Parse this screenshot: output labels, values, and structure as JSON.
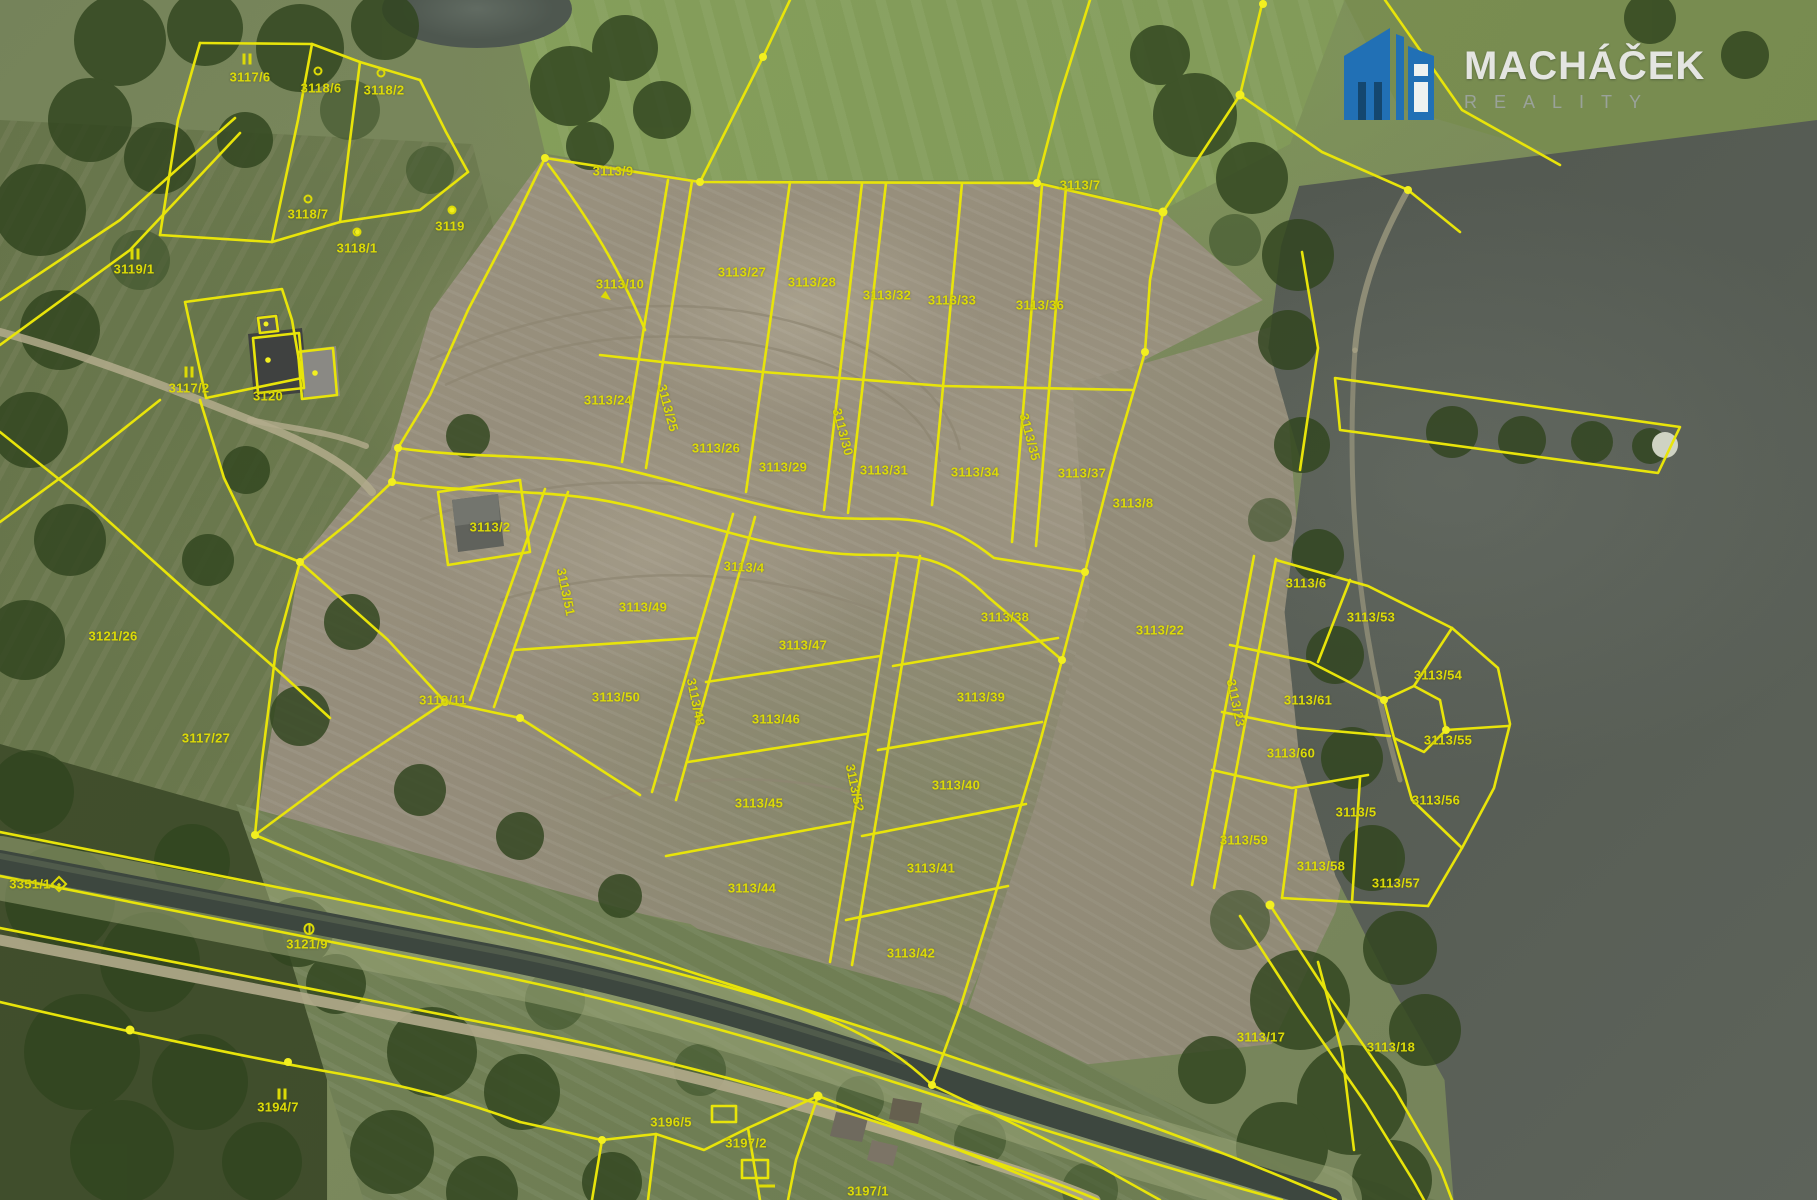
{
  "logo": {
    "title": "MACHÁČEK",
    "subtitle": "REALITY"
  },
  "map": {
    "colors": {
      "parcel_line": "#e8e40a",
      "parcel_label": "#dcda07",
      "logo_blue": "#2170b5",
      "logo_title": "#e4e5e1",
      "logo_subtitle": "#9aa29a",
      "water": "#575d56",
      "cleared_land": "#948c7a"
    },
    "parcel_labels": [
      {
        "t": "3117/6",
        "x": 250,
        "y": 77
      },
      {
        "t": "3118/6",
        "x": 321,
        "y": 88
      },
      {
        "t": "3118/2",
        "x": 384,
        "y": 90
      },
      {
        "t": "3118/7",
        "x": 308,
        "y": 214
      },
      {
        "t": "3119/1",
        "x": 134,
        "y": 269
      },
      {
        "t": "3118/1",
        "x": 357,
        "y": 248
      },
      {
        "t": "3119",
        "x": 450,
        "y": 226
      },
      {
        "t": "3113/9",
        "x": 613,
        "y": 171
      },
      {
        "t": "3113/7",
        "x": 1080,
        "y": 185
      },
      {
        "t": "3117/2",
        "x": 189,
        "y": 388
      },
      {
        "t": "3120",
        "x": 268,
        "y": 396
      },
      {
        "t": "3113/10",
        "x": 620,
        "y": 284
      },
      {
        "t": "3113/27",
        "x": 742,
        "y": 272
      },
      {
        "t": "3113/28",
        "x": 812,
        "y": 282
      },
      {
        "t": "3113/32",
        "x": 887,
        "y": 295
      },
      {
        "t": "3113/33",
        "x": 952,
        "y": 300
      },
      {
        "t": "3113/36",
        "x": 1040,
        "y": 305
      },
      {
        "t": "3113/24",
        "x": 608,
        "y": 400
      },
      {
        "t": "3113/25",
        "x": 668,
        "y": 408,
        "r": 75
      },
      {
        "t": "3113/26",
        "x": 716,
        "y": 448
      },
      {
        "t": "3113/29",
        "x": 783,
        "y": 467
      },
      {
        "t": "3113/30",
        "x": 843,
        "y": 432,
        "r": 75
      },
      {
        "t": "3113/31",
        "x": 884,
        "y": 470
      },
      {
        "t": "3113/34",
        "x": 975,
        "y": 472
      },
      {
        "t": "3113/35",
        "x": 1030,
        "y": 437,
        "r": 75
      },
      {
        "t": "3113/37",
        "x": 1082,
        "y": 473
      },
      {
        "t": "3113/4",
        "x": 744,
        "y": 567,
        "r": 3
      },
      {
        "t": "3113/2",
        "x": 490,
        "y": 527
      },
      {
        "t": "3113/51",
        "x": 566,
        "y": 592,
        "r": 78
      },
      {
        "t": "3113/49",
        "x": 643,
        "y": 607
      },
      {
        "t": "3113/50",
        "x": 616,
        "y": 697
      },
      {
        "t": "3113/48",
        "x": 696,
        "y": 702,
        "r": 78
      },
      {
        "t": "3113/47",
        "x": 803,
        "y": 645
      },
      {
        "t": "3113/46",
        "x": 776,
        "y": 719
      },
      {
        "t": "3113/45",
        "x": 759,
        "y": 803
      },
      {
        "t": "3113/52",
        "x": 855,
        "y": 788,
        "r": 78
      },
      {
        "t": "3113/44",
        "x": 752,
        "y": 888
      },
      {
        "t": "3113/38",
        "x": 1005,
        "y": 617
      },
      {
        "t": "3113/39",
        "x": 981,
        "y": 697
      },
      {
        "t": "3113/40",
        "x": 956,
        "y": 785
      },
      {
        "t": "3113/41",
        "x": 931,
        "y": 868
      },
      {
        "t": "3113/42",
        "x": 911,
        "y": 953
      },
      {
        "t": "3113/8",
        "x": 1133,
        "y": 503
      },
      {
        "t": "3113/22",
        "x": 1160,
        "y": 630
      },
      {
        "t": "3113/23",
        "x": 1236,
        "y": 703,
        "r": 78
      },
      {
        "t": "3113/61",
        "x": 1308,
        "y": 700
      },
      {
        "t": "3113/60",
        "x": 1291,
        "y": 753
      },
      {
        "t": "3113/59",
        "x": 1244,
        "y": 840
      },
      {
        "t": "3113/58",
        "x": 1321,
        "y": 866
      },
      {
        "t": "3113/57",
        "x": 1396,
        "y": 883
      },
      {
        "t": "3113/5",
        "x": 1356,
        "y": 812
      },
      {
        "t": "3113/6",
        "x": 1306,
        "y": 583
      },
      {
        "t": "3113/53",
        "x": 1371,
        "y": 617
      },
      {
        "t": "3113/54",
        "x": 1438,
        "y": 675
      },
      {
        "t": "3113/55",
        "x": 1448,
        "y": 740
      },
      {
        "t": "3113/56",
        "x": 1436,
        "y": 800
      },
      {
        "t": "3113/17",
        "x": 1261,
        "y": 1037
      },
      {
        "t": "3113/18",
        "x": 1391,
        "y": 1047
      },
      {
        "t": "3113/11",
        "x": 443,
        "y": 700
      },
      {
        "t": "3117/27",
        "x": 206,
        "y": 738
      },
      {
        "t": "3121/26",
        "x": 113,
        "y": 636
      },
      {
        "t": "3121/9",
        "x": 307,
        "y": 944
      },
      {
        "t": "3351/1",
        "x": 30,
        "y": 884
      },
      {
        "t": "3194/7",
        "x": 278,
        "y": 1107
      },
      {
        "t": "3196/5",
        "x": 671,
        "y": 1122
      },
      {
        "t": "3197/2",
        "x": 746,
        "y": 1143
      },
      {
        "t": "3197/1",
        "x": 868,
        "y": 1191
      }
    ],
    "survey_markers": [
      {
        "k": "ii",
        "x": 247,
        "y": 59
      },
      {
        "k": "ii",
        "x": 135,
        "y": 254
      },
      {
        "k": "ii",
        "x": 189,
        "y": 372
      },
      {
        "k": "ii",
        "x": 282,
        "y": 1094
      },
      {
        "k": "circle",
        "x": 318,
        "y": 71
      },
      {
        "k": "circle",
        "x": 381,
        "y": 73
      },
      {
        "k": "circle",
        "x": 308,
        "y": 199
      },
      {
        "k": "circle",
        "x": 357,
        "y": 232
      },
      {
        "k": "circle",
        "x": 452,
        "y": 210
      },
      {
        "k": "theta",
        "x": 309,
        "y": 929
      },
      {
        "k": "diamond",
        "x": 59,
        "y": 884
      },
      {
        "k": "arrow",
        "x": 607,
        "y": 297
      },
      {
        "k": "dash",
        "x": 767,
        "y": 1186
      }
    ]
  }
}
